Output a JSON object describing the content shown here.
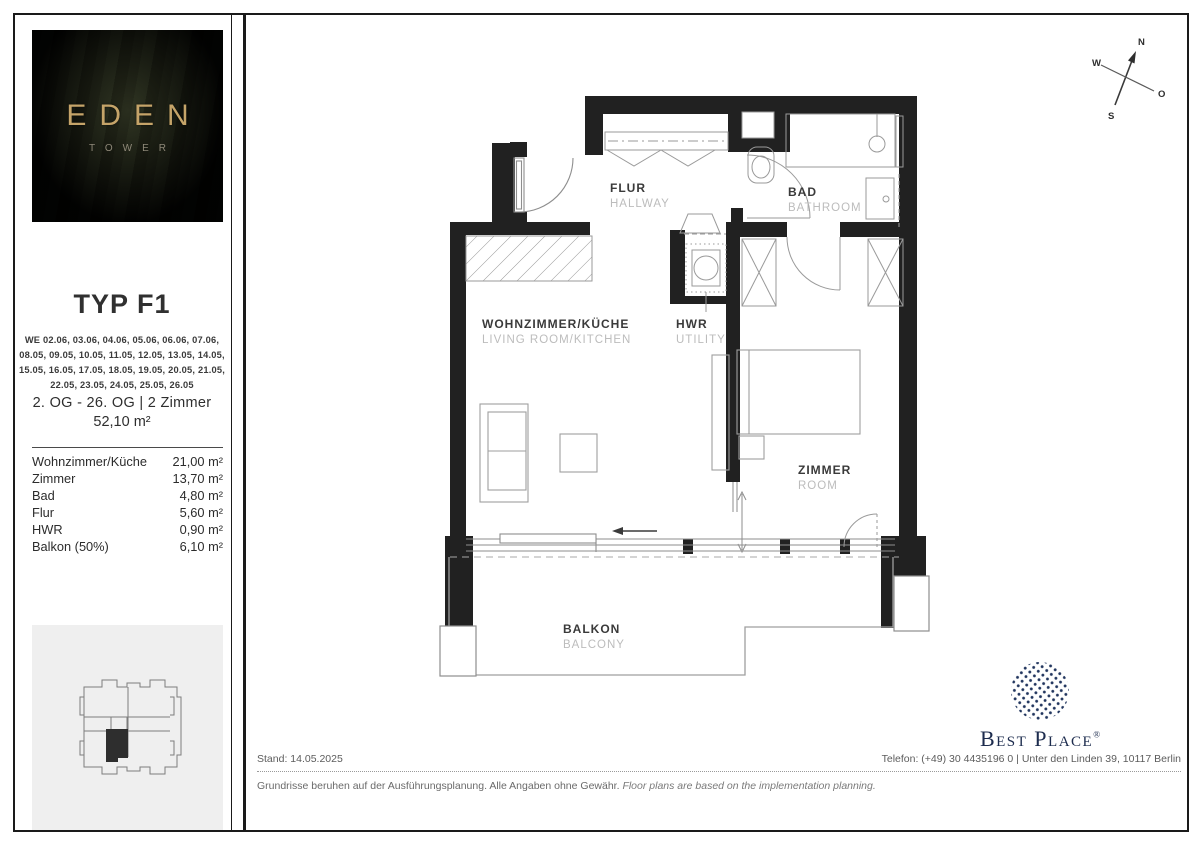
{
  "sidebar": {
    "logo": {
      "title": "EDEN",
      "subtitle": "TOWER"
    },
    "type_title": "TYP F1",
    "we_lines": [
      "WE 02.06, 03.06, 04.06, 05.06, 06.06, 07.06,",
      "08.05, 09.05, 10.05, 11.05, 12.05, 13.05, 14.05,",
      "15.05, 16.05, 17.05, 18.05, 19.05, 20.05, 21.05,",
      "22.05, 23.05, 24.05, 25.05, 26.05"
    ],
    "floors_line": "2. OG - 26. OG | 2 Zimmer",
    "area_total": "52,10 m²",
    "rooms": [
      {
        "label": "Wohnzimmer/Küche",
        "value": "21,00 m²"
      },
      {
        "label": "Zimmer",
        "value": "13,70 m²"
      },
      {
        "label": "Bad",
        "value": "4,80 m²"
      },
      {
        "label": "Flur",
        "value": "5,60 m²"
      },
      {
        "label": "HWR",
        "value": "0,90 m²"
      },
      {
        "label": "Balkon (50%)",
        "value": "6,10 m²"
      }
    ]
  },
  "plan": {
    "labels": {
      "flur_de": "FLUR",
      "flur_en": "HALLWAY",
      "bad_de": "BAD",
      "bad_en": "BATHROOM",
      "wohn_de": "WOHNZIMMER/KÜCHE",
      "wohn_en": "LIVING ROOM/KITCHEN",
      "hwr_de": "HWR",
      "hwr_en": "UTILITY",
      "zimmer_de": "ZIMMER",
      "zimmer_en": "ROOM",
      "balkon_de": "BALKON",
      "balkon_en": "BALCONY"
    },
    "compass": {
      "n": "N",
      "o": "O",
      "s": "S",
      "w": "W"
    }
  },
  "footer": {
    "stand": "Stand: 14.05.2025",
    "contact": "Telefon: (+49) 30 4435196 0 | Unter den Linden 39, 10117 Berlin",
    "disclaimer_de": "Grundrisse beruhen auf der Ausführungsplanung. Alle Angaben ohne Gewähr.",
    "disclaimer_en": "Floor plans are based on the implementation planning."
  },
  "brand": {
    "name": "Best Place",
    "registered": "®"
  },
  "colors": {
    "wall": "#212121",
    "accent_gold": "#c5a469",
    "brand_navy": "#1d2c4e"
  }
}
